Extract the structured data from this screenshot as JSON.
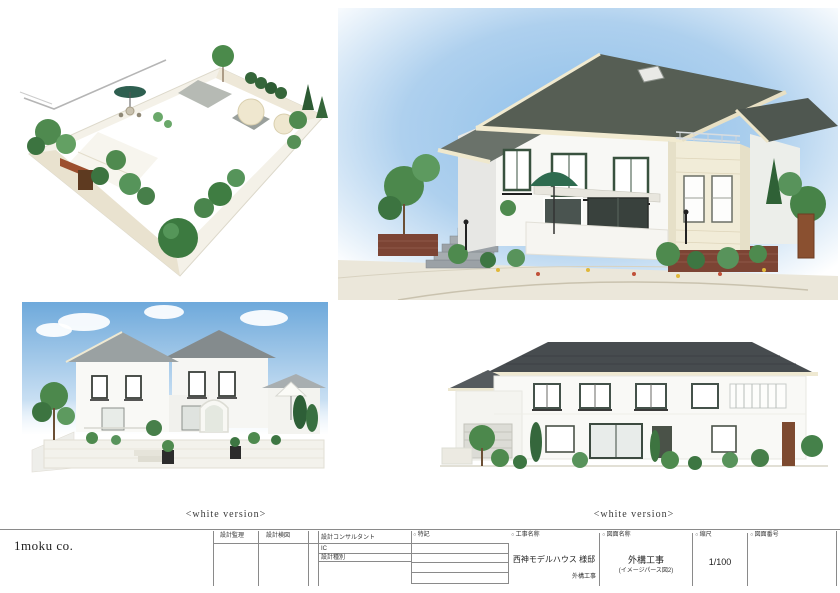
{
  "company": {
    "name": "1moku co."
  },
  "captions": {
    "bottom_left": "<white version>",
    "bottom_right": "<white version>"
  },
  "title_block": {
    "marker": "○",
    "design_supervision": "設計監理",
    "design_check": "設計検図",
    "consultant": "設計コンサルタント",
    "ic": "IC",
    "design_type": "設計種別",
    "notes": "特記",
    "work_name_label": "工事名称",
    "work_name": "西神モデルハウス 様邸",
    "work_name_sub": "外構工事",
    "drawing_name_label": "図面名称",
    "drawing_name": "外構工事",
    "drawing_name_sub": "(イメージパース図2)",
    "scale_label": "縮尺",
    "scale": "1/100",
    "drawing_no_label": "図面番号",
    "drawing_no": ""
  },
  "renders": {
    "garden_plan": "garden-plan-isometric-render",
    "main_perspective": "house-perspective-render",
    "white_left": "house-perspective-white-version-render",
    "white_right": "house-elevation-white-version-render"
  },
  "colors": {
    "roof_dark": "#474c4f",
    "roof_mid": "#565e54",
    "sky_blue": "#8ebfe9",
    "umbrella_green": "#2e6b4f",
    "brick": "#7c4434",
    "stone_cream": "#f1ecd8",
    "foliage": "#4e8a4e"
  }
}
